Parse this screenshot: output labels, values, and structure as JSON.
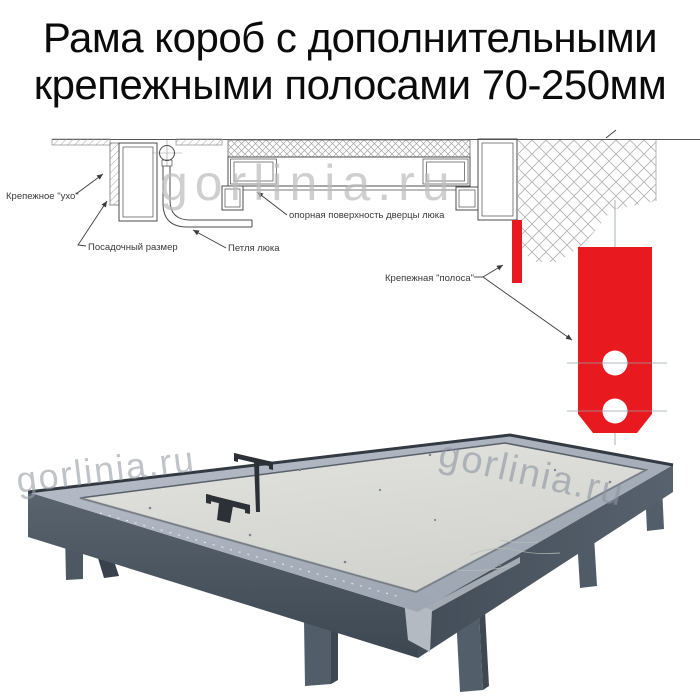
{
  "title": {
    "line1": "Рама короб с дополнительными",
    "line2": "крепежными полосами 70-250мм"
  },
  "diagram": {
    "labels": {
      "ear": "Крепежное \"ухо\"",
      "seat": "Посадочный размер",
      "hinge": "Петля люка",
      "support": "опорная поверхность дверцы люка",
      "strip": "Крепежная \"полоса\""
    },
    "colors": {
      "strip_red": "#e81a1f",
      "line": "#4c4c4c",
      "hatch": "#9b9b9b"
    }
  },
  "watermark": {
    "text": "gorlinia.ru"
  },
  "photo": {
    "frame_side_color": "#49535e",
    "rim_color": "#a6aeba",
    "panel_color": "#d9dad6",
    "leg_color": "#4e5a66",
    "handle_color": "#2c3137"
  }
}
